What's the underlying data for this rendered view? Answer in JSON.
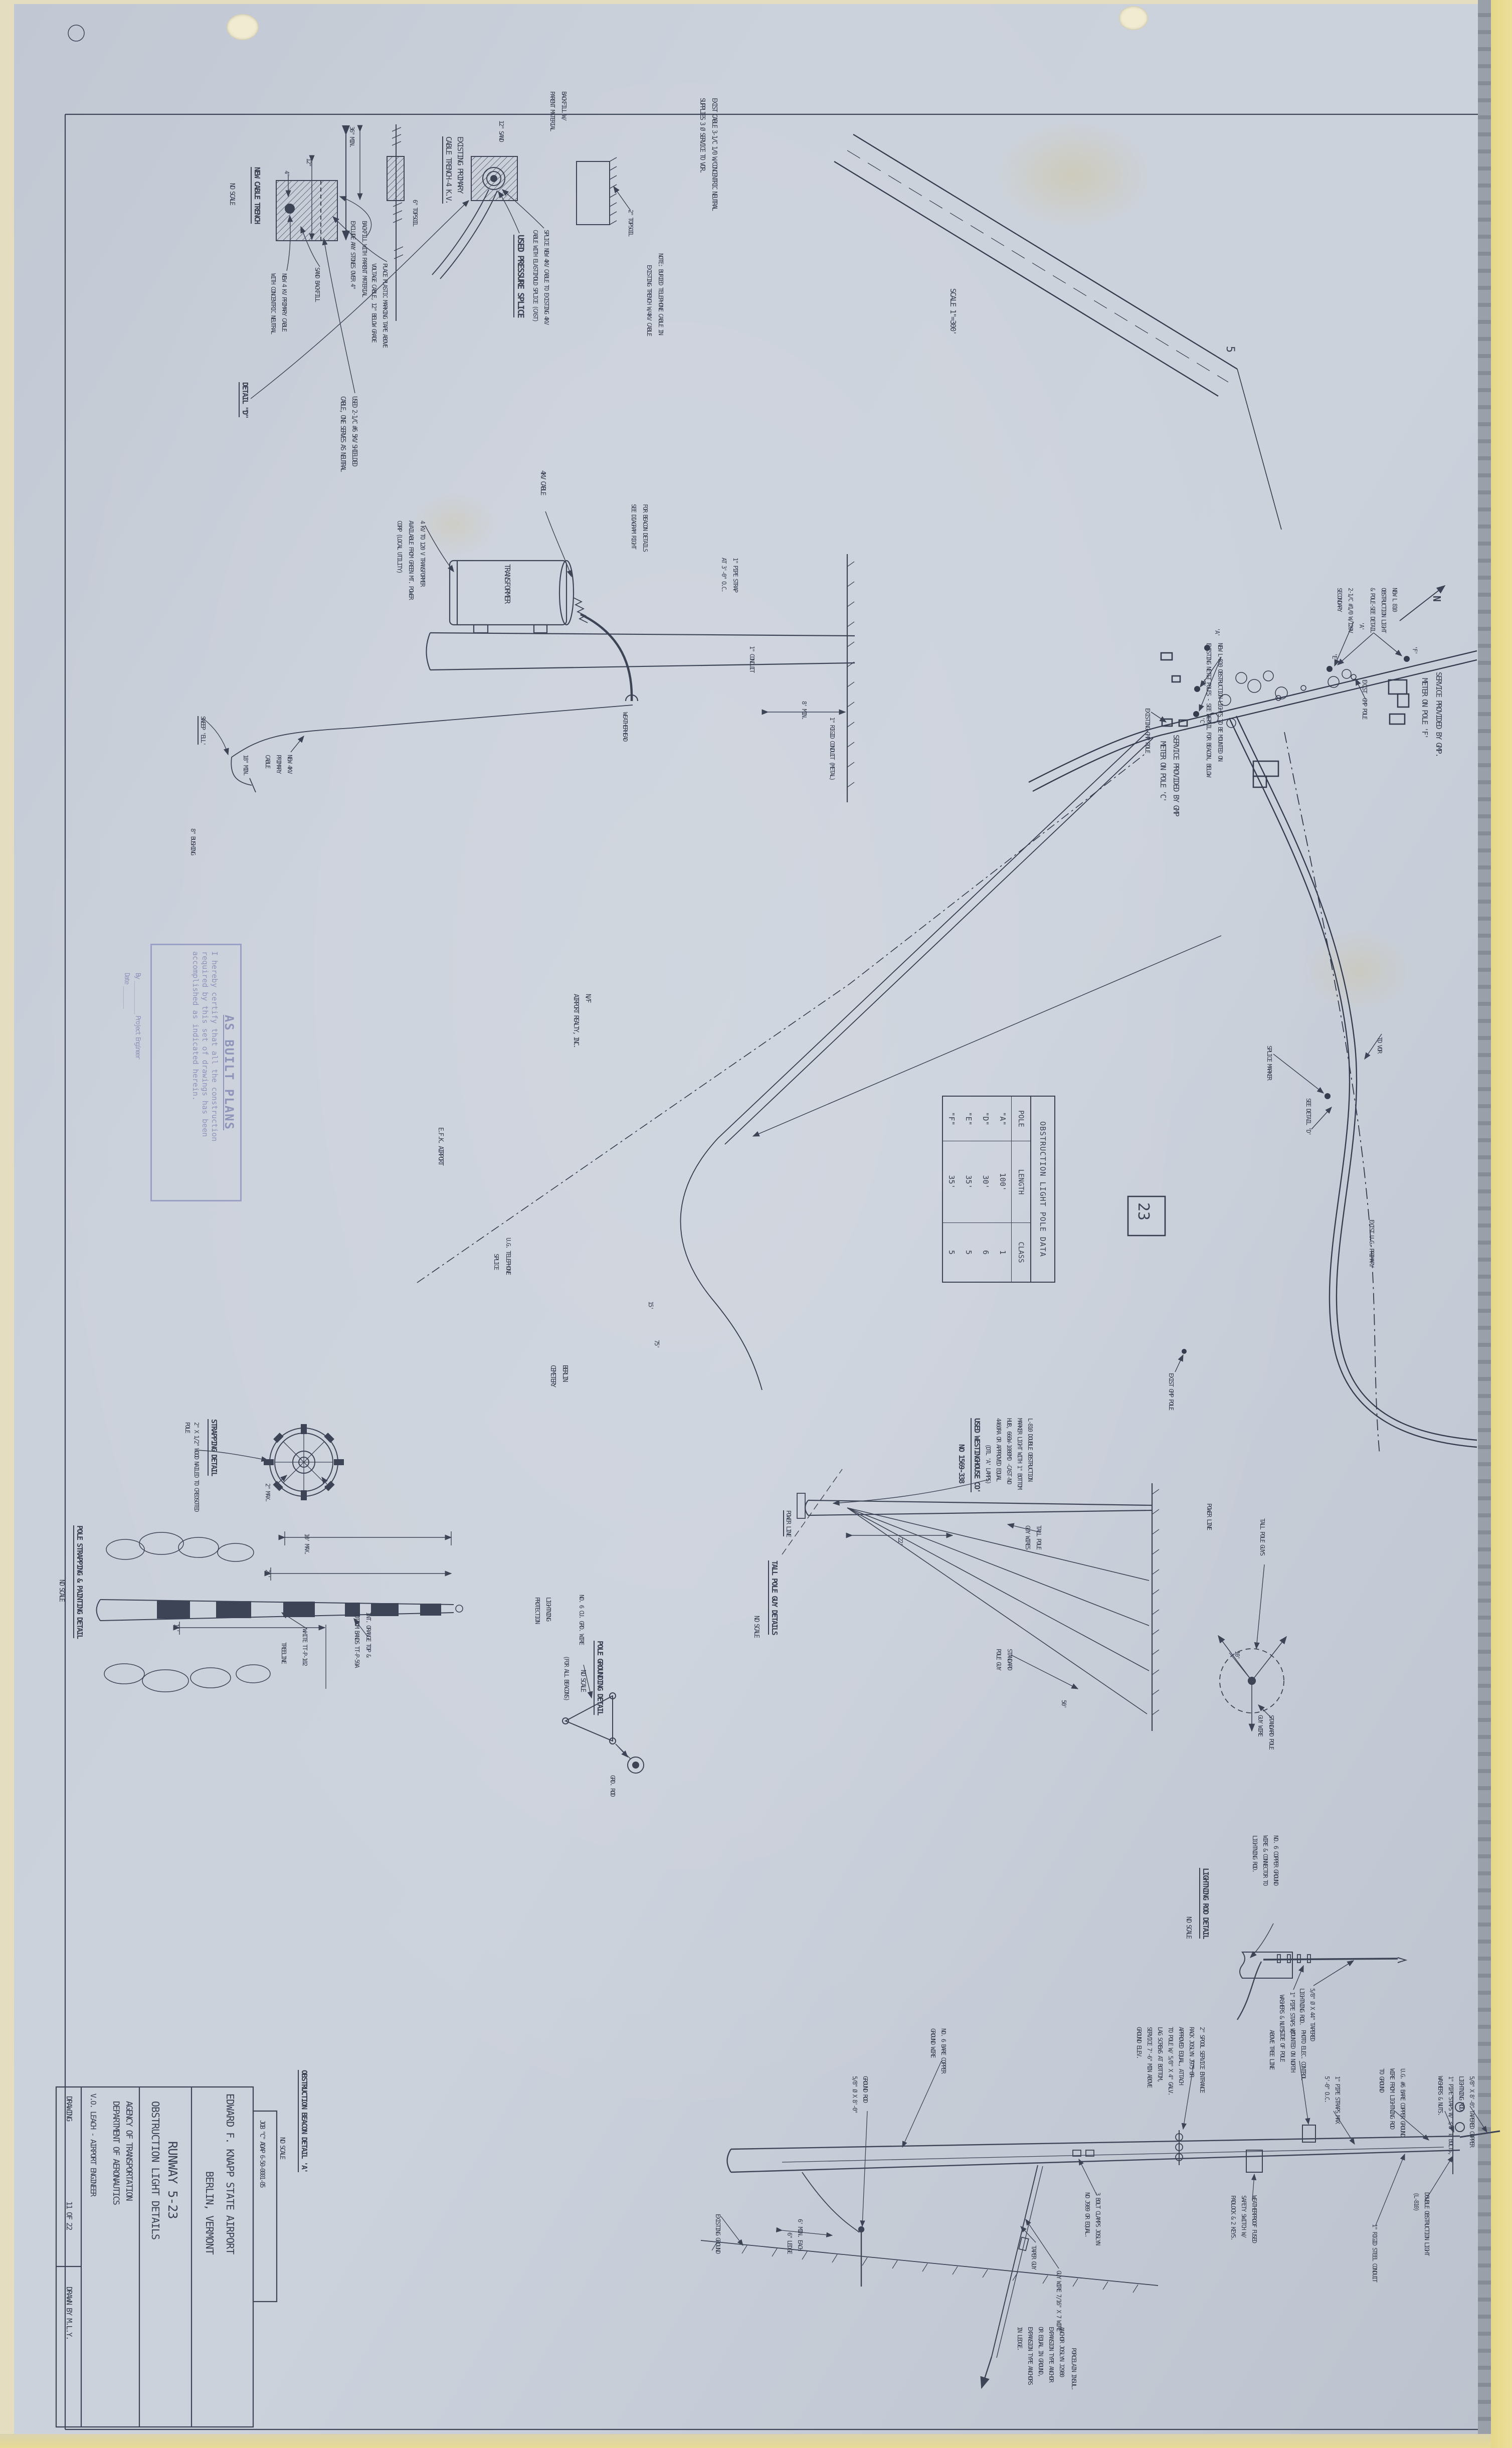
{
  "title_block": {
    "job": "JOB \"C\"  ADAP  6-50-0001-05",
    "airport": "EDWARD F. KNAPP STATE AIRPORT",
    "city": "BERLIN, VERMONT",
    "runway": "RUNWAY 5-23",
    "sheet_title": "OBSTRUCTION LIGHT DETAILS",
    "agency": "AGENCY OF TRANSPORTATION",
    "department": "DEPARTMENT OF AERONAUTICS",
    "engineer": "V.O. LEACH - AIRPORT ENGINEER",
    "drawing_label": "DRAWING",
    "sheet_no": "11 OF 22",
    "drawn_by": "DRAWN BY M.L.Y."
  },
  "stamp": {
    "title": "AS BUILT PLANS",
    "line1": "I hereby certify that all the construction",
    "line2": "required by this set of drawings has been",
    "line3": "accomplished as indicated herein.",
    "by_line": "By ____________  Project Engineer",
    "date_line": "Date ________"
  },
  "beacon_title": {
    "t": "OBSTRUCTION BEACON DETAIL 'A'",
    "s": "NO SCALE"
  },
  "topleft": {
    "exist1": "EXIST CABLE 3-1/C 1/0 W/CONCENTRIC NEUTRAL",
    "exist2": "SUPPLIES 3 Ø SERVICE TO VOR.",
    "topsoil2": "2\" TOPSOIL",
    "note1": "NOTE: BURIED TELEPHONE CABLE IN",
    "note2": "EXISTING TRENCH W/4KV CABLE"
  },
  "nct": {
    "title": "NEW CABLE TRENCH",
    "scale": "NO SCALE",
    "detail_ref": "DETAIL \"D\"",
    "dim36": "36\" MIN.",
    "dim12": "12\"",
    "dim4": "4\"",
    "backfill1": "BACKFILL WITH PARENT MATERIAL",
    "backfill2": "EXCLUDE ANY STONES OVER 4\"",
    "tape1": "PLACE PLASTIC MARKING TAPE ABOVE",
    "tape2": "VOLTAGE CABLE, 12\" BELOW GRADE",
    "sand": "SAND BACKFILL",
    "new1": "NEW 4 KV PRIMARY CABLE",
    "new2": "WITH CONCENTRIC NEUTRAL",
    "used1": "USED 2-1/C #6 5KV SHIELDED",
    "used2": "CABLE, ONE SERVES AS NEUTRAL"
  },
  "et": {
    "title1": "EXISTING PRIMARY",
    "title2": "CABLE TRENCH-4 K.V.",
    "back1": "BACKFILL W/",
    "back2": "PARENT MATERIAL",
    "sand": "12\" SAND",
    "topsoil": "6\" TOPSOIL"
  },
  "ps": {
    "note1": "SPLICE NEW 4KV CABLE TO EXISTING 4KV",
    "note2": "CABLE WITH ELASTIMOLD SPLICE (CAST)",
    "title": "USED PRESSURE SPLICE"
  },
  "tr": {
    "cable": "4KV CABLE",
    "n1": "4 KV TO 120 V TRANSFORMER",
    "n2": "AVAILABLE FROM GREEN MT. POWER",
    "n3": "CORP (LOCAL UTILITY)",
    "b1": "FOR BEACON DETAILS",
    "b2": "SEE DIAGRAM RIGHT",
    "label": "TRANSFORMER",
    "s1": "1\" PIPE STRAP",
    "s2": "AT 3'-0\" O.C.",
    "conduit": "1\" CONDUIT",
    "wh": "WEATHERHEAD",
    "min8": "8' MIN.",
    "rigid": "1\" RIGID CONDUIT (METAL)",
    "sweep": "SWEEP 'ELL'",
    "min18": "18\" MIN.",
    "nc1": "NEW 4KV",
    "nc2": "PRIMARY",
    "nc3": "CABLE",
    "bushing": "8\" BUSHING"
  },
  "map": {
    "scale": "SCALE 1\"=300'",
    "north": "N",
    "rw5": "5",
    "ref23": "23",
    "svcf1": "SERVICE PROVIDED BY GMP.",
    "svcf2": "METER ON POLE 'F'",
    "nl1": "NEW L 810",
    "nl2": "OBSTRUCTION LIGHT",
    "nl3": "& POLE-SEE DETAIL",
    "nl4": "'A'",
    "sec1": "2-1/C #1/0 W/120V",
    "sec2": "SECONDARY",
    "egp1": "EXIST. GMP POLE",
    "m1": "NEW L-810 OBSTRUCTION LIGHTS TO BE MOUNTED ON",
    "m2": "EXISTING NET&T POLES - SEE DETAIL FOR BEACON, BELOW",
    "svcc1": "SERVICE PROVIDED BY GMP",
    "svcc2": "METER ON POLE 'C'",
    "egp2": "EXISTING GMP POLE",
    "tovor": "TO VOR",
    "ugp": "EXIST U.G. PRIMARY",
    "spm": "SPLICE MARKER",
    "seed": "SEE DETAIL 'D'",
    "egp3": "EXIST GMP POLE",
    "pa": "'A'",
    "pb": "'B'",
    "pc": "'C'",
    "pe": "'E'",
    "pf": "'F'",
    "nf1": "N/F",
    "nf2": "AIRPORT REALTY, INC.",
    "efk": "E.F.K. AIRPORT",
    "cem1": "BERLIN",
    "cem2": "CEMETERY",
    "tel1": "U.G. TELEPHONE",
    "tel2": "SPLICE",
    "d15": "15'",
    "d75": "75'"
  },
  "pole_table": {
    "title": "OBSTRUCTION LIGHT POLE DATA",
    "headers": [
      "POLE",
      "LENGTH",
      "CLASS"
    ],
    "rows": [
      {
        "pole": "\"A\"",
        "length": "100'",
        "cls": "1"
      },
      {
        "pole": "\"D\"",
        "length": "30'",
        "cls": "6"
      },
      {
        "pole": "\"E\"",
        "length": "35'",
        "cls": "5"
      },
      {
        "pole": "\"F\"",
        "length": "35'",
        "cls": "5"
      }
    ]
  },
  "wh": {
    "l1": "L-810 DOUBLE OBSTRUCTION",
    "l2": "MARKER LIGHT WITH 1\" BOTTOM",
    "l3": "HUB, 660W-1080MD -CAST-NO",
    "l4": "4460RA OR APPROVED EQUAL",
    "l5": "(DTL 'A' LAMPS)",
    "u1": "USED WESTINGHOUSE CO'",
    "u2": "NO 1569-338"
  },
  "sd": {
    "title": "STRAPPING DETAIL",
    "n1": "2\" X 1/2\" WOOD NAILED TO CREOSOTED",
    "n2": "POLE",
    "d1": "2\" MAX.",
    "d2": "2\""
  },
  "pp": {
    "title": "POLE STRAPPING & PAINTING DETAIL",
    "scale": "NO SCALE",
    "d10": "10' MAX.",
    "d21": "21'",
    "d11": "11'",
    "white": "WHITE TT-P-102",
    "or1": "INT. ORANGE TOP &",
    "or2": "BOTTOM BANDS TT-P-59A",
    "tree": "TREELINE"
  },
  "gr": {
    "lp1": "LIGHTNING",
    "lp2": "PROTECTION",
    "wire": "NO. 6 CU. GRD. WIRE",
    "rod": "GRD. ROD",
    "title": "POLE GROUNDING DETAIL",
    "scale": "NO SCALE",
    "note": "(FOR ALL BEACONS)"
  },
  "tg": {
    "title": "TALL POLE GUY DETAILS",
    "scale": "NO SCALE",
    "power": "POWER LINE",
    "w1": "TALL POLE",
    "w2": "GUY WIRES",
    "d22": "22'",
    "d50": "50'",
    "d10": "10'",
    "std1": "STANDARD",
    "std2": "POLE GUY",
    "power2": "POWER LINE",
    "tpg": "TALL POLE GUYS",
    "spg1": "STANDARD POLE",
    "spg2": "GUY WIRE"
  },
  "lr": {
    "title": "LIGHTNING ROD DETAIL",
    "scale": "NO SCALE",
    "g1": "NO. 6 COPPER GROUND",
    "g2": "WIRE & CONNECTOR TO",
    "g3": "LIGHTNING ROD.",
    "s1": "1\" PIPE STAPS W/",
    "s2": "WASHERS & NUTS",
    "r1": "5/8\" Ø X 44\" TAPERED",
    "r2": "LIGHTNING ROD."
  },
  "bc": {
    "rod1": "5/8\" X 8'-0\" TAPERED COPPER",
    "rod2": "LIGHTNING ROD.",
    "st1": "1\" PIPE STAPS W/ 3/8\" Ø BOLTS,",
    "st2": "WASHERS & NUTS.",
    "dbl1": "DOUBLE OBSTRUCTION LIGHT",
    "dbl2": "(L-810)",
    "ug1": "U.G. #6 BARE COPPER GROUND",
    "ug2": "WIRE FROM LIGHTNING ROD",
    "ug3": "TO GROUND",
    "rigid": "1\" RIGID STEEL CONDUIT",
    "ps1": "1\" PIPE STRAPS MAX",
    "ps2": "5'-0\" O.C.",
    "ph1": "PHOTO ELEC. CONTROL",
    "ph2": "MOUNTED ON NORTH",
    "ph3": "SIDE OF POLE",
    "ph4": "ABOVE TREE LINE",
    "sw1": "WEATHERPROOF FUSED",
    "sw2": "SAFETY SWITCH W/",
    "sw3": "PADLOCK & 2 KEYS.",
    "rk1": "2\" SPOOL SERVICE ENTRANCE",
    "rk2": "RACK JOSLYN J975 OR",
    "rk3": "APPROVED EQUAL, ATTACH",
    "rk4": "TO POLE W/ 5/8\" X 4\" GALV.",
    "rk5": "LAG SCREWS AT BOTTOM,",
    "rk6": "SERVICE 7'-6\" MIN ABOVE",
    "rk7": "GROUND ELEV.",
    "cl1": "3 BOLT CLAMPS JOSLYN",
    "cl2": "NO J989 OR EQUAL.",
    "guy": "GUY WIRE 7/16\" X 7 WIRE",
    "taper": "TAPER GUY",
    "porc": "PORCELAIN INSUL.",
    "an1": "ANCHOR JOSLYN J2980",
    "an2": "EXPANSION TYPE ANCHOR",
    "an3": "OR EQUAL IN GROUND,",
    "an4": "EXPANSION TYPE ANCHORS",
    "an5": "IN LEDGE.",
    "gw1": "NO. 6 BARE COPPER",
    "gw2": "GROUND WIRE",
    "gr1": "GROUND ROD",
    "gr2": "5/8\" Ø X 8'-0\"",
    "m6": "6' MIN. EACH",
    "ledge": "6\" LEDGE",
    "exg": "EXISTING GROUND"
  }
}
